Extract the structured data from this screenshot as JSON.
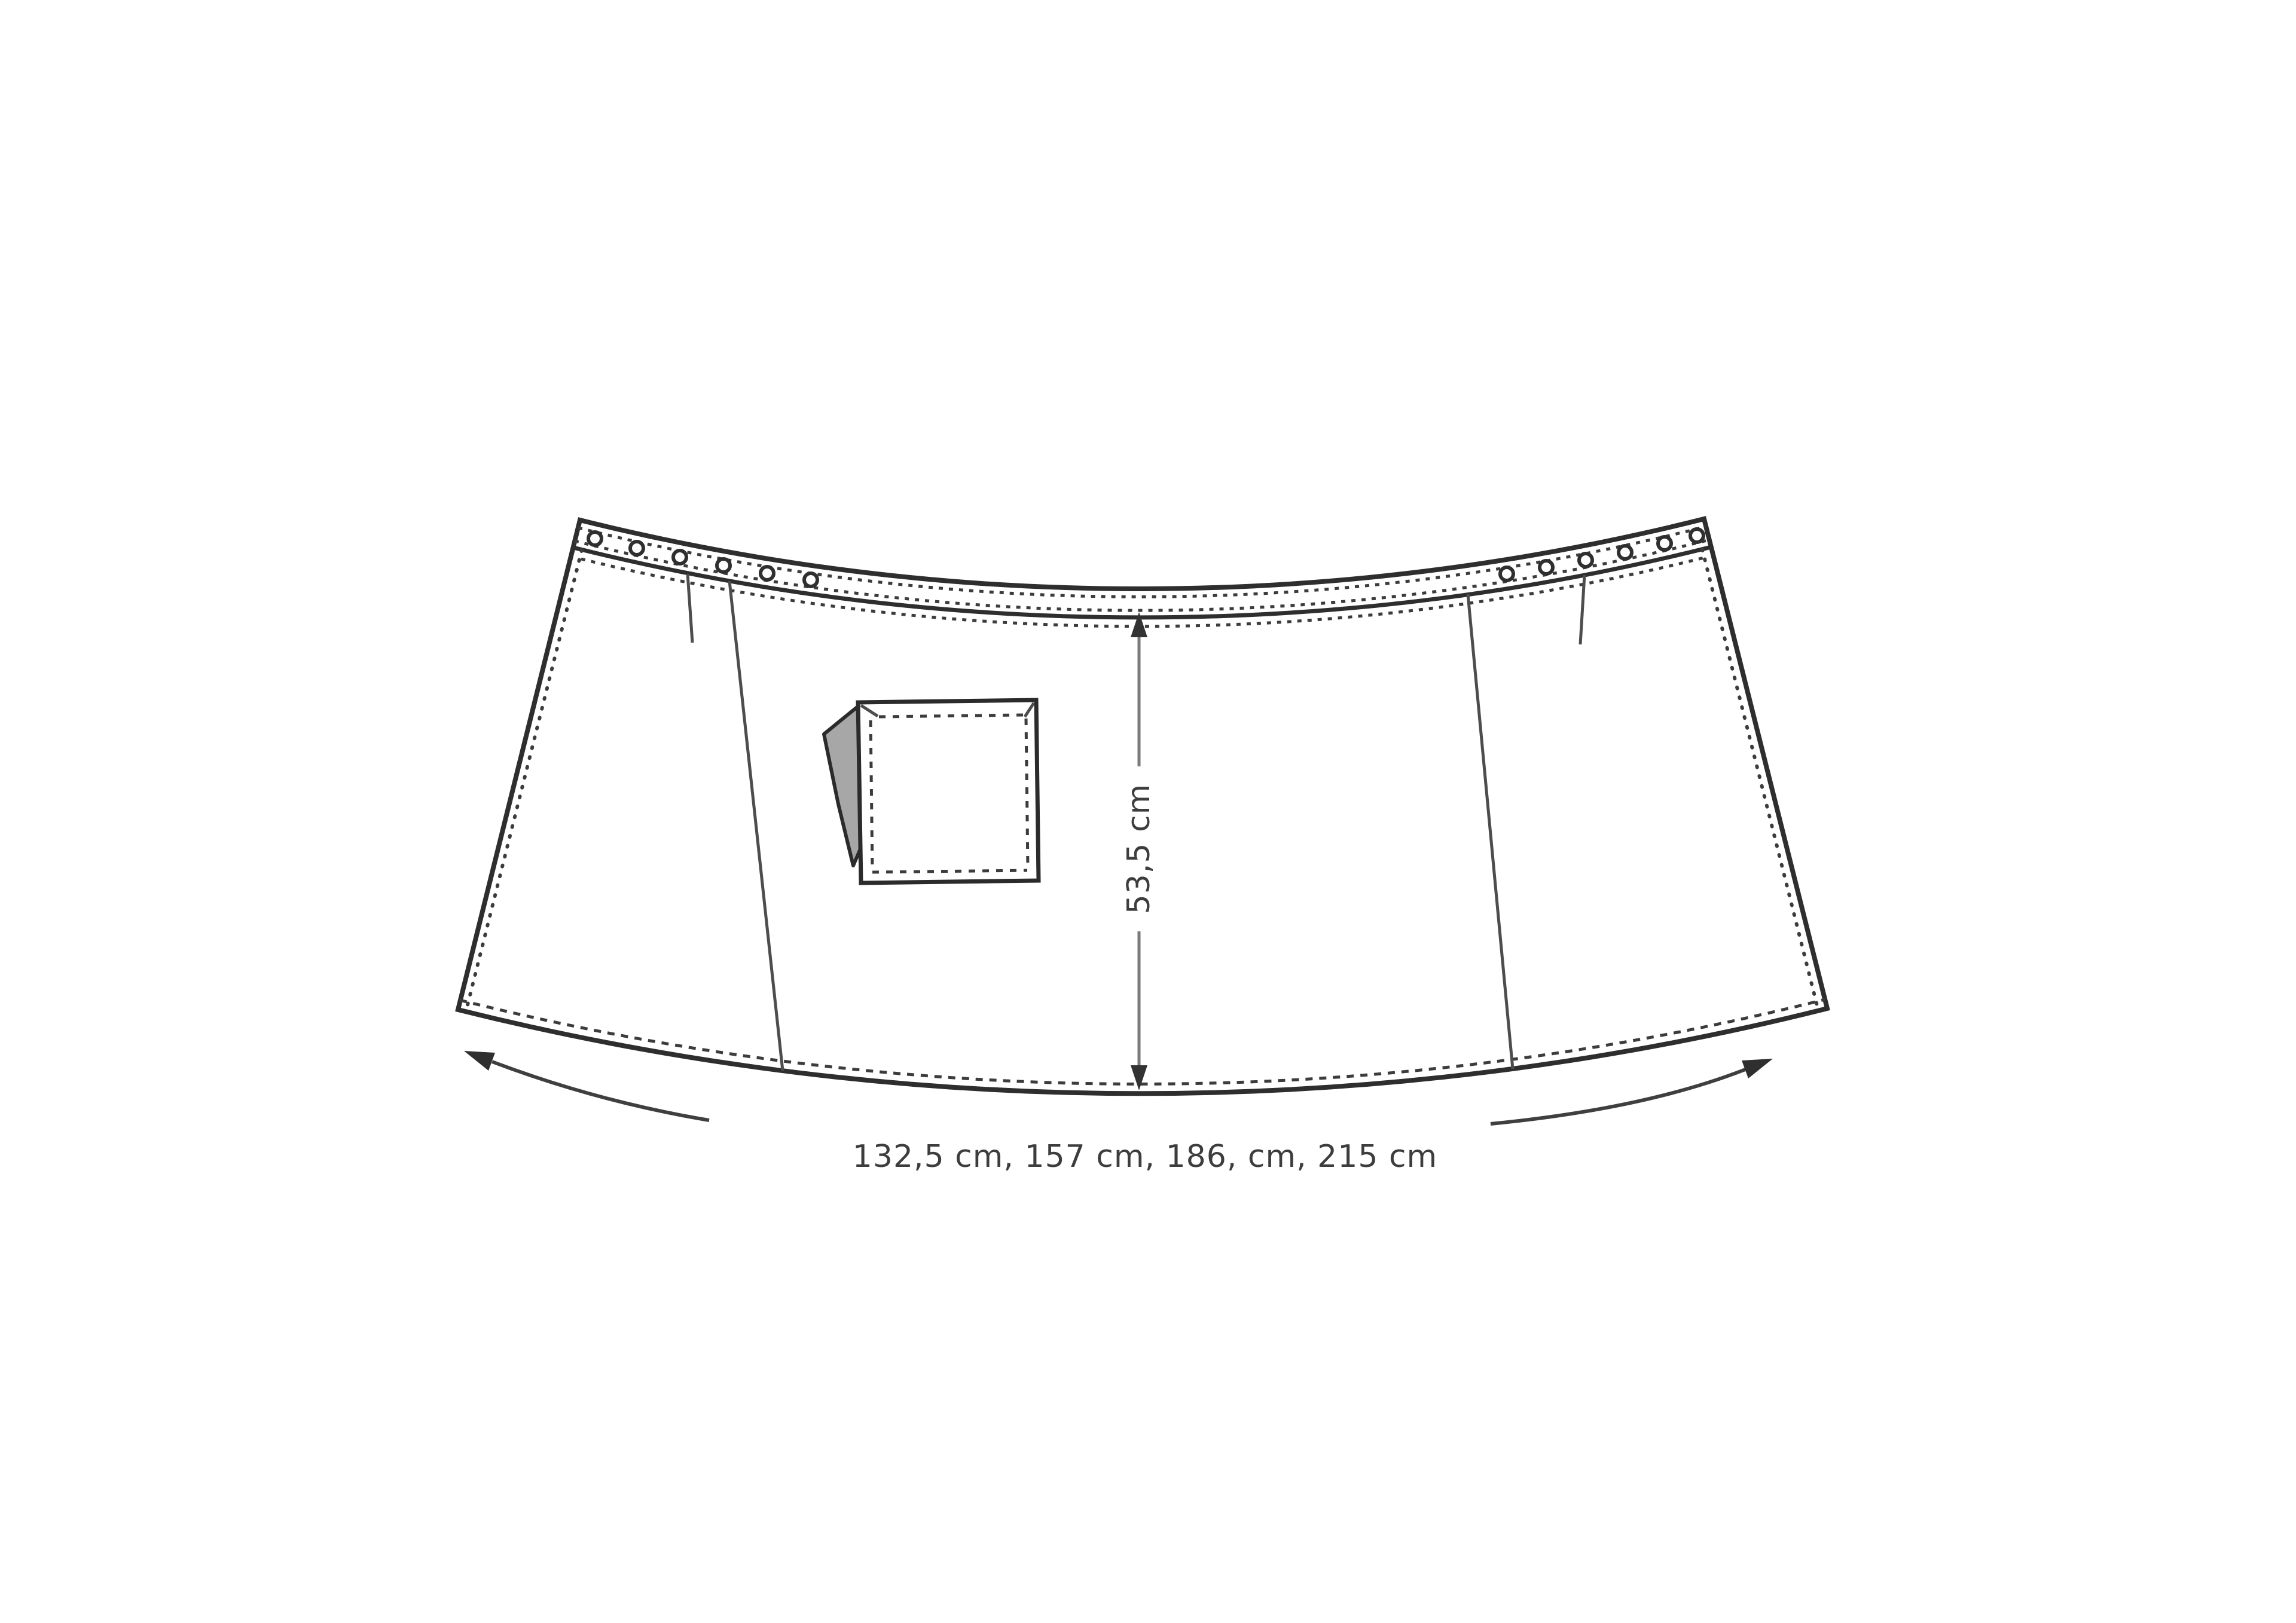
{
  "diagram": {
    "kind": "sewing-pattern technical drawing",
    "subject": "curved waist apron / skirt panel, flat pattern view",
    "labels": {
      "height_dimension": "53,5 cm",
      "width_dimension": "132,5 cm, 157 cm, 186, cm, 215 cm"
    },
    "sizes_cm": [
      "132,5",
      "157",
      "186",
      "215"
    ],
    "waistband": {
      "eyelets_left_count": 6,
      "eyelets_right_count": 6,
      "darts_count": 2,
      "panel_seams_count": 2
    },
    "pocket": {
      "type": "square patch pocket",
      "has_folded_flap": true
    },
    "colors": {
      "background": "#ffffff",
      "outline": "#2e2e2e",
      "stitching": "#3c3c3c",
      "dimension_line": "#7a7a7a",
      "dimension_text": "#3d3d3d",
      "flap_fill": "#a7a7a7"
    }
  }
}
